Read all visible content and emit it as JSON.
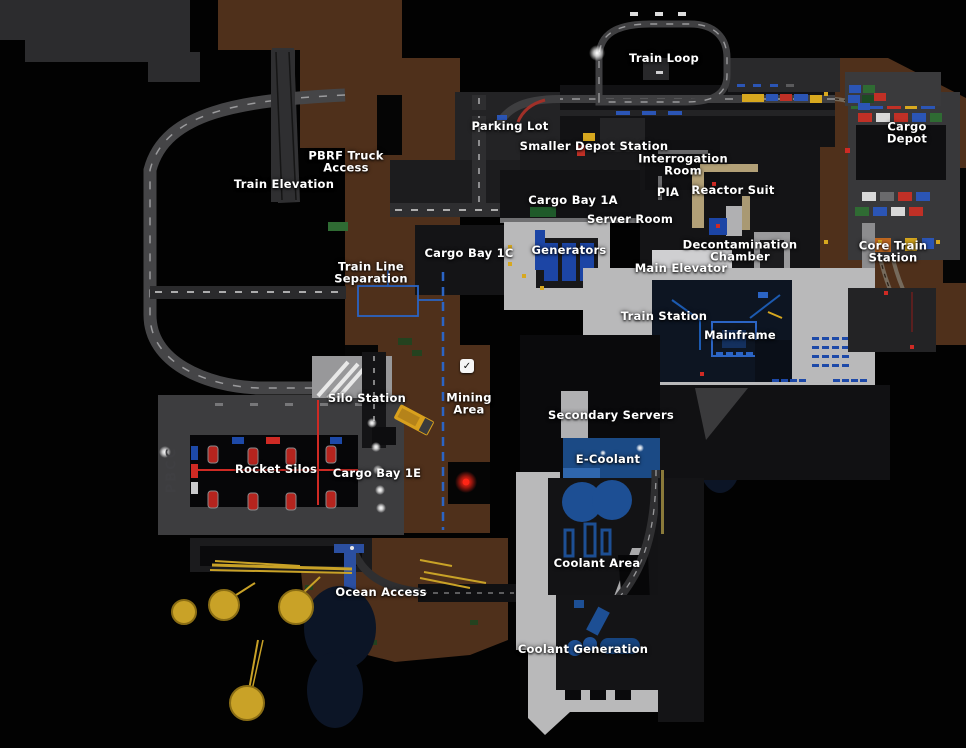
{
  "map": {
    "labels": [
      {
        "id": "train-loop",
        "text": "Train Loop",
        "x": 664,
        "y": 58
      },
      {
        "id": "parking-lot",
        "text": "Parking Lot",
        "x": 510,
        "y": 126
      },
      {
        "id": "smaller-depot-station",
        "text": "Smaller Depot Station",
        "x": 594,
        "y": 146
      },
      {
        "id": "cargo-depot",
        "text": "Cargo Depot",
        "x": 907,
        "y": 133
      },
      {
        "id": "interrogation-room",
        "text": "Interrogation\nRoom",
        "x": 683,
        "y": 165
      },
      {
        "id": "pbrf-truck-access",
        "text": "PBRF Truck\nAccess",
        "x": 346,
        "y": 162
      },
      {
        "id": "train-elevation",
        "text": "Train Elevation",
        "x": 284,
        "y": 184
      },
      {
        "id": "reactor-suit",
        "text": "Reactor Suit",
        "x": 733,
        "y": 190
      },
      {
        "id": "pia",
        "text": "PIA",
        "x": 668,
        "y": 192
      },
      {
        "id": "cargo-bay-1a",
        "text": "Cargo Bay 1A",
        "x": 573,
        "y": 200
      },
      {
        "id": "server-room",
        "text": "Server Room",
        "x": 630,
        "y": 219
      },
      {
        "id": "generators",
        "text": "Generators",
        "x": 569,
        "y": 250
      },
      {
        "id": "decontamination-chamber",
        "text": "Decontamination\nChamber",
        "x": 740,
        "y": 251
      },
      {
        "id": "core-train-station",
        "text": "Core Train Station",
        "x": 893,
        "y": 252
      },
      {
        "id": "cargo-bay-1c",
        "text": "Cargo Bay 1C",
        "x": 469,
        "y": 253
      },
      {
        "id": "main-elevator",
        "text": "Main Elevator",
        "x": 681,
        "y": 268
      },
      {
        "id": "train-line-separation",
        "text": "Train Line\nSeparation",
        "x": 371,
        "y": 273
      },
      {
        "id": "train-station",
        "text": "Train Station",
        "x": 664,
        "y": 316
      },
      {
        "id": "mainframe",
        "text": "Mainframe",
        "x": 740,
        "y": 335
      },
      {
        "id": "silo-station",
        "text": "Silo Station",
        "x": 367,
        "y": 398
      },
      {
        "id": "mining-area",
        "text": "Mining\nArea",
        "x": 469,
        "y": 404
      },
      {
        "id": "secondary-servers",
        "text": "Secondary Servers",
        "x": 611,
        "y": 415
      },
      {
        "id": "rocket-silos",
        "text": "Rocket Silos",
        "x": 276,
        "y": 469
      },
      {
        "id": "cargo-bay-1e",
        "text": "Cargo Bay 1E",
        "x": 377,
        "y": 473
      },
      {
        "id": "e-coolant",
        "text": "E-Coolant",
        "x": 608,
        "y": 459
      },
      {
        "id": "coolant-area",
        "text": "Coolant Area",
        "x": 597,
        "y": 563
      },
      {
        "id": "ocean-access",
        "text": "Ocean Access",
        "x": 381,
        "y": 592
      },
      {
        "id": "coolant-generation",
        "text": "Coolant Generation",
        "x": 583,
        "y": 649
      }
    ],
    "marker": {
      "name": "checkbox-checked",
      "glyph": "✓",
      "x": 467,
      "y": 366
    },
    "wall_text": {
      "text": "PBCC",
      "x": 172,
      "y": 470
    },
    "colors": {
      "background": "#020202",
      "terrain_brown": "#4f301b",
      "plateau_gray": "#2c2c2e",
      "concrete": "#b9b9ba",
      "accent_blue": "#1d49a8",
      "accent_red": "#cf2a24",
      "accent_yellow": "#d7a81f",
      "label_text": "#ffffff"
    }
  }
}
